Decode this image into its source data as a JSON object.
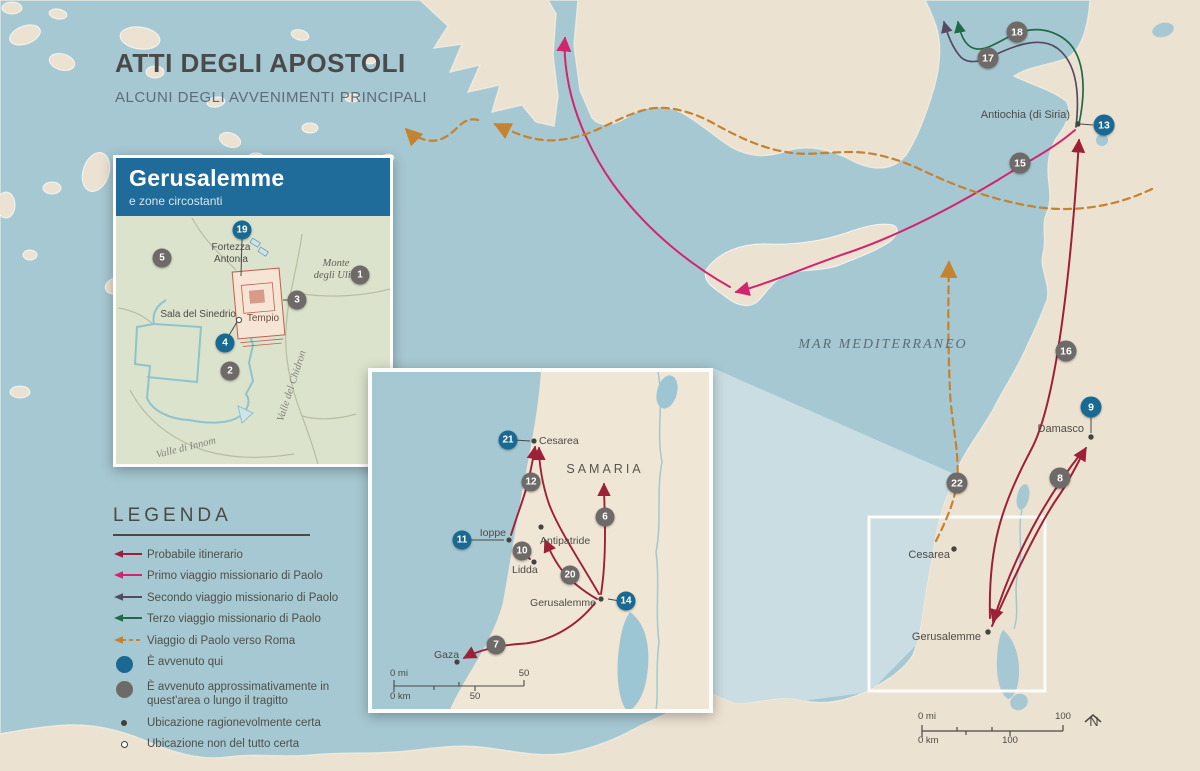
{
  "title": {
    "heading": "ATTI DEGLI APOSTOLI",
    "subheading": "ALCUNI DEGLI AVVENIMENTI PRINCIPALI"
  },
  "main_map": {
    "sea_label": "MAR MEDITERRANEO",
    "places": {
      "antiochia": "Antiochia (di Siria)",
      "damasco": "Damasco",
      "cesarea": "Cesarea",
      "gerusalemme": "Gerusalemme"
    },
    "badges": {
      "b8": "8",
      "b9": "9",
      "b13": "13",
      "b15": "15",
      "b16": "16",
      "b17": "17",
      "b18": "18",
      "b22": "22"
    },
    "scale": {
      "mi0": "0 mi",
      "mi_max": "100",
      "km0": "0 km",
      "km_max": "100"
    },
    "north": "N"
  },
  "jerusalem_inset": {
    "title": "Gerusalemme",
    "subtitle": "e zone circostanti",
    "places": {
      "fortezza": "Fortezza\nAntonia",
      "monte": "Monte\ndegli Ulivi",
      "sinedrio": "Sala del Sinedrio",
      "tempio": "Tempio",
      "chidron": "Valle del Chidron",
      "innom": "Valle di Innom"
    },
    "badges": {
      "b1": "1",
      "b2": "2",
      "b3": "3",
      "b4": "4",
      "b5": "5",
      "b19": "19"
    }
  },
  "samaria_inset": {
    "region_label": "SAMARIA",
    "places": {
      "cesarea": "Cesarea",
      "ioppe": "Ioppe",
      "antipatride": "Antipatride",
      "lidda": "Lidda",
      "gerusalemme": "Gerusalemme",
      "gaza": "Gaza"
    },
    "badges": {
      "b6": "6",
      "b7": "7",
      "b10": "10",
      "b11": "11",
      "b12": "12",
      "b14": "14",
      "b20": "20",
      "b21": "21"
    },
    "scale": {
      "mi0": "0 mi",
      "mi_max": "50",
      "km0": "0 km",
      "km_max": "50"
    }
  },
  "legend": {
    "title": "LEGENDA",
    "items": [
      {
        "label": "Probabile itinerario",
        "type": "arrow",
        "color": "#9c2138"
      },
      {
        "label": "Primo viaggio missionario di Paolo",
        "type": "arrow",
        "color": "#d2256d"
      },
      {
        "label": "Secondo viaggio missionario di Paolo",
        "type": "arrow",
        "color": "#564a62"
      },
      {
        "label": "Terzo viaggio missionario di Paolo",
        "type": "arrow",
        "color": "#1f6b45"
      },
      {
        "label": "Viaggio di Paolo verso Roma",
        "type": "arrow-dashed",
        "color": "#c5822f"
      },
      {
        "label": "È avvenuto qui",
        "type": "circle-blue",
        "color": "#196992"
      },
      {
        "label": "È avvenuto approssimativamente in quest'area o lungo il tragitto",
        "type": "circle-gray",
        "color": "#6e6a67"
      },
      {
        "label": "Ubicazione ragionevolmente certa",
        "type": "dot-filled",
        "color": "#3f3f3a"
      },
      {
        "label": "Ubicazione non del tutto certa",
        "type": "dot-open",
        "color": "#3f3f3a"
      }
    ]
  },
  "colors": {
    "sea": "#a6c8d2",
    "land": "#ece2d2",
    "projection_beam": "#c9dde3",
    "inset_land": "#f0e6d6",
    "jerusalem_land": "#dbe3cd",
    "inset_header": "#1f6b99",
    "badge_blue": "#196992",
    "badge_gray": "#6e6a67",
    "route_probable": "#9c2138",
    "route_first": "#d2256d",
    "route_second": "#564a62",
    "route_third": "#1f6b45",
    "route_rome": "#c5822f"
  }
}
